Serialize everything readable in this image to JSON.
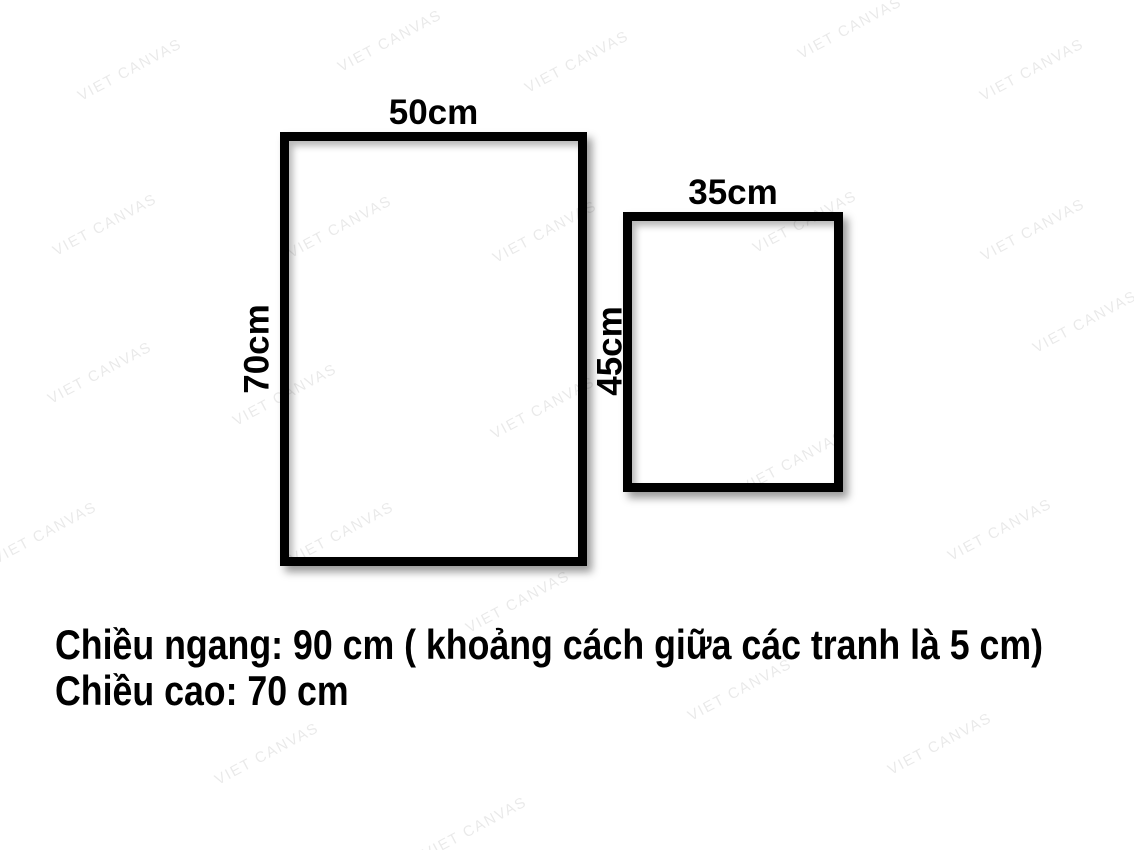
{
  "watermark": {
    "text": "VIET CANVAS"
  },
  "frames": [
    {
      "id": "frame-large",
      "width_label": "50cm",
      "height_label": "70cm"
    },
    {
      "id": "frame-small",
      "width_label": "35cm",
      "height_label": "45cm"
    }
  ],
  "caption": {
    "line1": "Chiều ngang: 90 cm ( khoảng cách giữa các tranh là 5 cm)",
    "line2": "Chiều cao: 70 cm"
  },
  "colors": {
    "background": "#ffffff",
    "frame_border": "#000000",
    "text": "#000000",
    "watermark_gray": "#e8e8e8"
  }
}
